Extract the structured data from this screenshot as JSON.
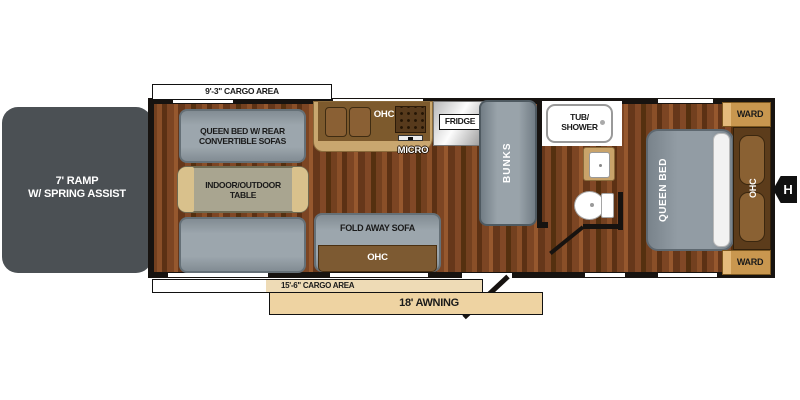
{
  "plan_title": "travel trailer floor plan",
  "colors": {
    "wall": "#171310",
    "wood_floor": "#7c4523",
    "furniture_gray": "#9ca6ad",
    "ramp_gray": "#4b5054",
    "cabinet_brown": "#7d5a2d",
    "ward_tan": "#c9974f",
    "awning_tan": "#eed3a2",
    "measure_white": "#ffffff"
  },
  "ramp": {
    "line1": "7' RAMP",
    "line2": "W/ SPRING ASSIST"
  },
  "measurements": {
    "top": "9'-3\" CARGO AREA",
    "bottom": "15'-6\" CARGO AREA",
    "awning": "18' AWNING"
  },
  "garage": {
    "sofa_line1": "QUEEN BED W/ REAR",
    "sofa_line2": "CONVERTIBLE SOFAS",
    "table_line1": "INDOOR/OUTDOOR",
    "table_line2": "TABLE"
  },
  "kitchen": {
    "ohc": "OHC",
    "micro": "MICRO",
    "fridge": "FRIDGE"
  },
  "living": {
    "fold_sofa": "FOLD AWAY SOFA",
    "ohc": "OHC"
  },
  "bunks_label": "BUNKS",
  "bath": {
    "tub_line1": "TUB/",
    "tub_line2": "SHOWER"
  },
  "bedroom": {
    "bed": "QUEEN BED",
    "ohc": "OHC",
    "ward_top": "WARD",
    "ward_bottom": "WARD"
  },
  "hitch_marker": "H"
}
